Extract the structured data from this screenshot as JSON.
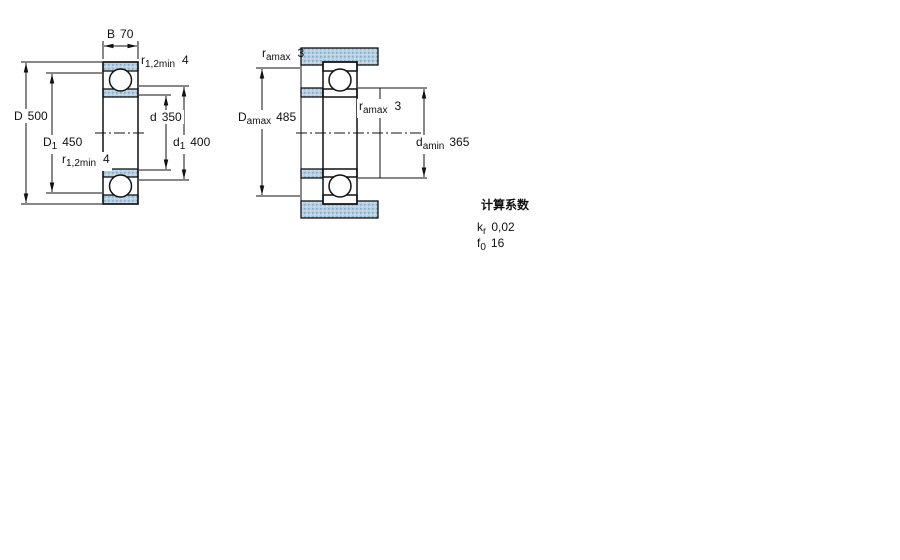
{
  "colors": {
    "line": "#111111",
    "hatch_base": "#b5cfe3",
    "hatch_dot_dark": "#86acc9",
    "hatch_dot_light": "#dae8f2",
    "ball_fill": "#ffffff",
    "background": "#ffffff"
  },
  "left_diagram": {
    "dims": {
      "B": {
        "symbol": "B",
        "value": "70"
      },
      "r_top": {
        "symbol": "r",
        "sub": "1,2min",
        "value": "4"
      },
      "D": {
        "symbol": "D",
        "value": "500"
      },
      "D1": {
        "symbol": "D",
        "sub": "1",
        "value": "450"
      },
      "r_bottom": {
        "symbol": "r",
        "sub": "1,2min",
        "value": "4"
      },
      "d": {
        "symbol": "d",
        "value": "350"
      },
      "d1": {
        "symbol": "d",
        "sub": "1",
        "value": "400"
      }
    }
  },
  "right_diagram": {
    "dims": {
      "r_top": {
        "symbol": "r",
        "sub": "amax",
        "value": "3"
      },
      "Damax": {
        "symbol": "D",
        "sub": "amax",
        "value": "485"
      },
      "r_mid": {
        "symbol": "r",
        "sub": "amax",
        "value": "3"
      },
      "damin": {
        "symbol": "d",
        "sub": "amin",
        "value": "365"
      }
    }
  },
  "calculation_factors": {
    "title": "计算系数",
    "rows": [
      {
        "symbol": "k",
        "sub": "r",
        "value": "0,02"
      },
      {
        "symbol": "f",
        "sub": "0",
        "value": "16"
      }
    ]
  }
}
